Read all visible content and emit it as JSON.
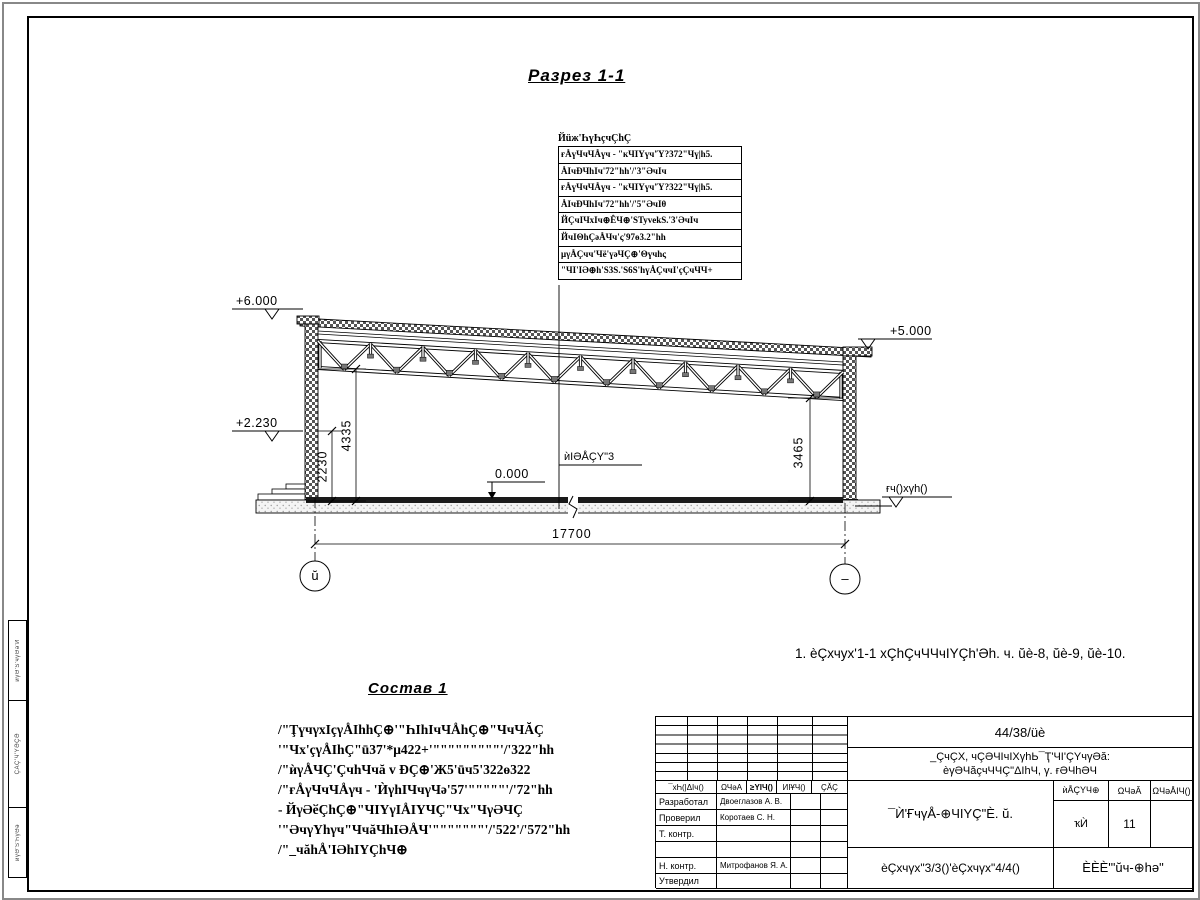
{
  "page": {
    "section_title": "Разрез 1-1",
    "sostav_title": "Состав 1",
    "note": "1. èÇхчух'1-1 хÇhÇчЧЧчIYÇh'Әh. ч. ŭè-8, ŭè-9, ŭè-10."
  },
  "callout": {
    "header": "Йüж'ҺүҺçчÇhÇ",
    "rows": [
      "ғÅүЧчЧÅүч - \"кЧIYүч'Ύ?372\"Чү|h5.",
      "ÅIчÐЧhIч'72\"hh'/'3\"ӘчIч",
      "ғÅүЧчЧÅүч - \"кЧIYүч'Ύ?322\"Чү|h5.",
      "ÅIчÐЧhIч'72\"hh'/'5\"ӘчIθ",
      "ЙÇчIЧхIч⊕ÊЧ⊕'ЅTyvekЅ.'3'ӘчIч",
      "ЙчIΘhÇәÅЧч'ς'97ө3.2\"hh",
      "μγÅÇчч'Чё'үәЧÇ⊕'Θүчhς",
      "\"ЧI'IӘ⊕h'Ѕ3Ѕ.'Ѕ6Ѕ'hүÅÇччI'çÇчЧЧ+"
    ]
  },
  "levels": {
    "left_top": "+6.000",
    "left_mid": "+2.230",
    "right_top": "+5.000",
    "zero": "0.000",
    "floor_label": "ѝIӘÅÇY\"3",
    "ground_label": "ғч()хγh()"
  },
  "dimensions": {
    "v_2230": "2230",
    "v_4335": "4335",
    "v_3465": "3465",
    "h_total": "17700"
  },
  "axes": {
    "left": "ŭ",
    "right": "–"
  },
  "sostav": {
    "lines": [
      "/\"ŢүчγхIçγÅIhhÇ⊕'\"ҺIhIчЧÅhÇ⊕\"ЧчЧĂÇ",
      "'\"Чх'çγÅIhÇ\"ū37'*μ422+'\"\"\"\"\"\"\"\"\"'/'322\"hh",
      "/\"ѝγÅЧÇ'ÇчhЧчă v ÐÇ⊕'Ж5'ūч5'322ө322",
      "/\"ғÅγЧчЧÅγч - 'ЍγhIЧчγЧә'57'\"\"\"\"\"'/'72\"hh",
      "- ЙγӘӗÇhÇ⊕\"ЧIYγIÅIYЧÇ\"Чх\"ЧγӘЧÇ",
      "'\"ӘчγYhγч\"ЧчăЧhIӘÅЧ'\"\"\"\"\"\"\"'/'522'/'572\"hh",
      "/\"_чăhÅ'IӘhIYÇhЧ⊕"
    ]
  },
  "titleblock": {
    "code": "44/38/üè",
    "object_line1": "_ÇчÇХ, чÇӘЧIчIХγhЬ¯Ҭ'ЧI'ÇYчγӘă:",
    "object_line2": "èγӘЧăçчЧЧÇ\"ΔIhЧ, γ. ғӘЧhӘЧ",
    "header_cols": [
      "¯хҺ(|ΔIч()",
      "ΩЧәА",
      "≥YIЧ()",
      "ИIҰЧ()",
      "ÇĂÇ"
    ],
    "roles": [
      "Разработал",
      "Проверил",
      "Т. контр.",
      "",
      "Н. контр.",
      "Утвердил"
    ],
    "names": [
      "Двоеглазов А. В.",
      "Коротаев С. Н.",
      "",
      "",
      "Митрофанов Я. А.",
      ""
    ],
    "doc_title": "¯Ѝ'ҒчγÅ-⊕ЧIYÇ\"È. ŭ.",
    "stage_headers": [
      "ѝÅÇYЧ⊕",
      "ΩЧәĂ",
      "ΩЧәÅIЧ()"
    ],
    "stage_values": [
      "ҡЍ",
      "11",
      ""
    ],
    "sheet_label": "èÇхчγх\"3/3()'èÇхчγх\"4/4()",
    "company": "ÈÈÈ'\"ŭч-⊕hә\""
  },
  "side_strip": {
    "cells": [
      "ѝγӘ'Ѕ'чγӘә'И",
      "ÇĂÇ'Ч'YӘҪӘ",
      "ѝγӘ'Ѕ'ҺγӘә"
    ]
  },
  "colors": {
    "ink": "#000000",
    "hatch": "#444444",
    "fill_dark": "#1a1a1a"
  }
}
